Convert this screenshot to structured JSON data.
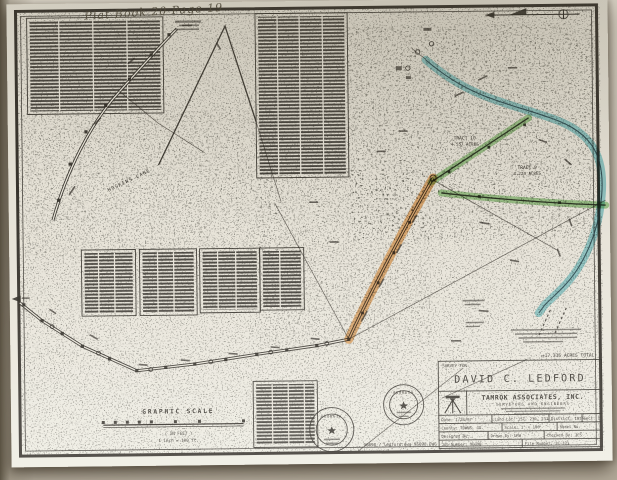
{
  "plat": {
    "handwritten_note": "Plat Book 20  Page 19",
    "north_arrow_label": "MAGNETIC",
    "labels": {
      "hoskins_lane": "HOSKINS LANE",
      "acres_total": "±17.336 ACRES TOTAL"
    },
    "tracts": [
      {
        "name": "TRACT 10",
        "acres": "4.557 ACRES"
      },
      {
        "name": "TRACT 9",
        "acres": "4.224 ACRES"
      }
    ],
    "graphic_scale": {
      "title": "GRAPHIC SCALE",
      "units": "( IN FEET )",
      "ratio": "1 inch = 100 ft."
    },
    "seals": {
      "left": "GEORGIA",
      "right": "GEORGIA"
    },
    "file_note": "96098 / ledford.dwg   96098.DWG",
    "title_block": {
      "survey_for": "SURVEY FOR:",
      "client": "DAVID C. LEDFORD",
      "firm": "TAMROK ASSOCIATES, INC.",
      "firm_subtitle": "SURVEYORS AND ENGINEERS",
      "rows": [
        [
          "Date: 1/28/97",
          "Land Lot: 157, 230, 231",
          "District: 18th",
          "Sect. 1"
        ],
        [
          "County: TOWNS, GA.",
          "Scale: 1\" = 100'",
          "Sheet No."
        ],
        [
          "Designed By:",
          "Drawn By: LRW",
          "Checked By: JCS"
        ],
        [
          "Job Number: 96098",
          "File Number: 2C-371"
        ]
      ]
    },
    "colors": {
      "highlight_orange": "#e08a2e",
      "highlight_green": "#5fb04a",
      "highlight_blue": "#45b4c2",
      "ink": "#2e2a24",
      "paper": "#e8e4d9"
    }
  }
}
